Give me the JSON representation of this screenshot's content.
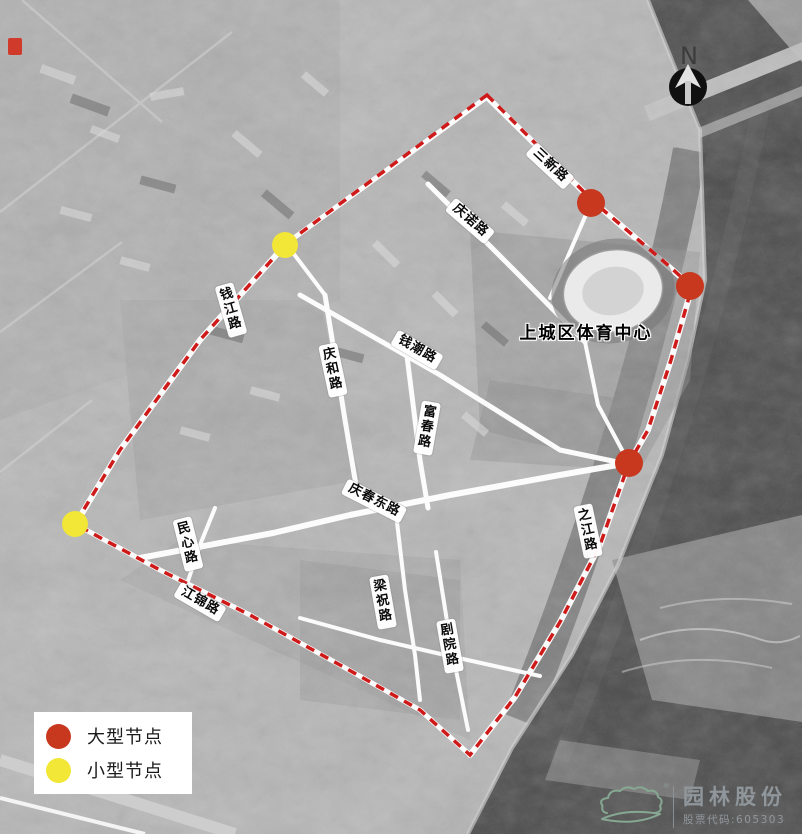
{
  "north": {
    "label": "N"
  },
  "site_label": "上城区体育中心",
  "roads": [
    {
      "id": "sanxin",
      "text": "三新路"
    },
    {
      "id": "qingnuo",
      "text": "庆诺路"
    },
    {
      "id": "qianjiang",
      "text": "钱江路"
    },
    {
      "id": "qianchao",
      "text": "钱潮路"
    },
    {
      "id": "qinghe",
      "text": "庆和路"
    },
    {
      "id": "fuchun",
      "text": "富春路"
    },
    {
      "id": "qingchundong",
      "text": "庆春东路"
    },
    {
      "id": "zhijiang",
      "text": "之江路"
    },
    {
      "id": "minxin",
      "text": "民心路"
    },
    {
      "id": "jiangjin",
      "text": "江锦路"
    },
    {
      "id": "liangzhu",
      "text": "梁祝路"
    },
    {
      "id": "juyuan",
      "text": "剧院路"
    }
  ],
  "nodes": {
    "large": {
      "label": "大型节点",
      "color": "#c8381f",
      "radius": 14,
      "positions": [
        [
          591,
          203
        ],
        [
          690,
          286
        ],
        [
          629,
          463
        ]
      ]
    },
    "small": {
      "label": "小型节点",
      "color": "#f2e636",
      "radius": 13,
      "positions": [
        [
          285,
          245
        ],
        [
          75,
          524
        ]
      ]
    }
  },
  "legend": {
    "items": [
      {
        "label": "大型节点",
        "color": "#c8381f"
      },
      {
        "label": "小型节点",
        "color": "#f2e636"
      }
    ]
  },
  "boundary_color": "#cf1a1a",
  "logo": {
    "name": "园林股份",
    "stock_code": "股票代码:605303",
    "reg": "®",
    "brand_color": "#86a893",
    "text_color": "#90979c"
  }
}
